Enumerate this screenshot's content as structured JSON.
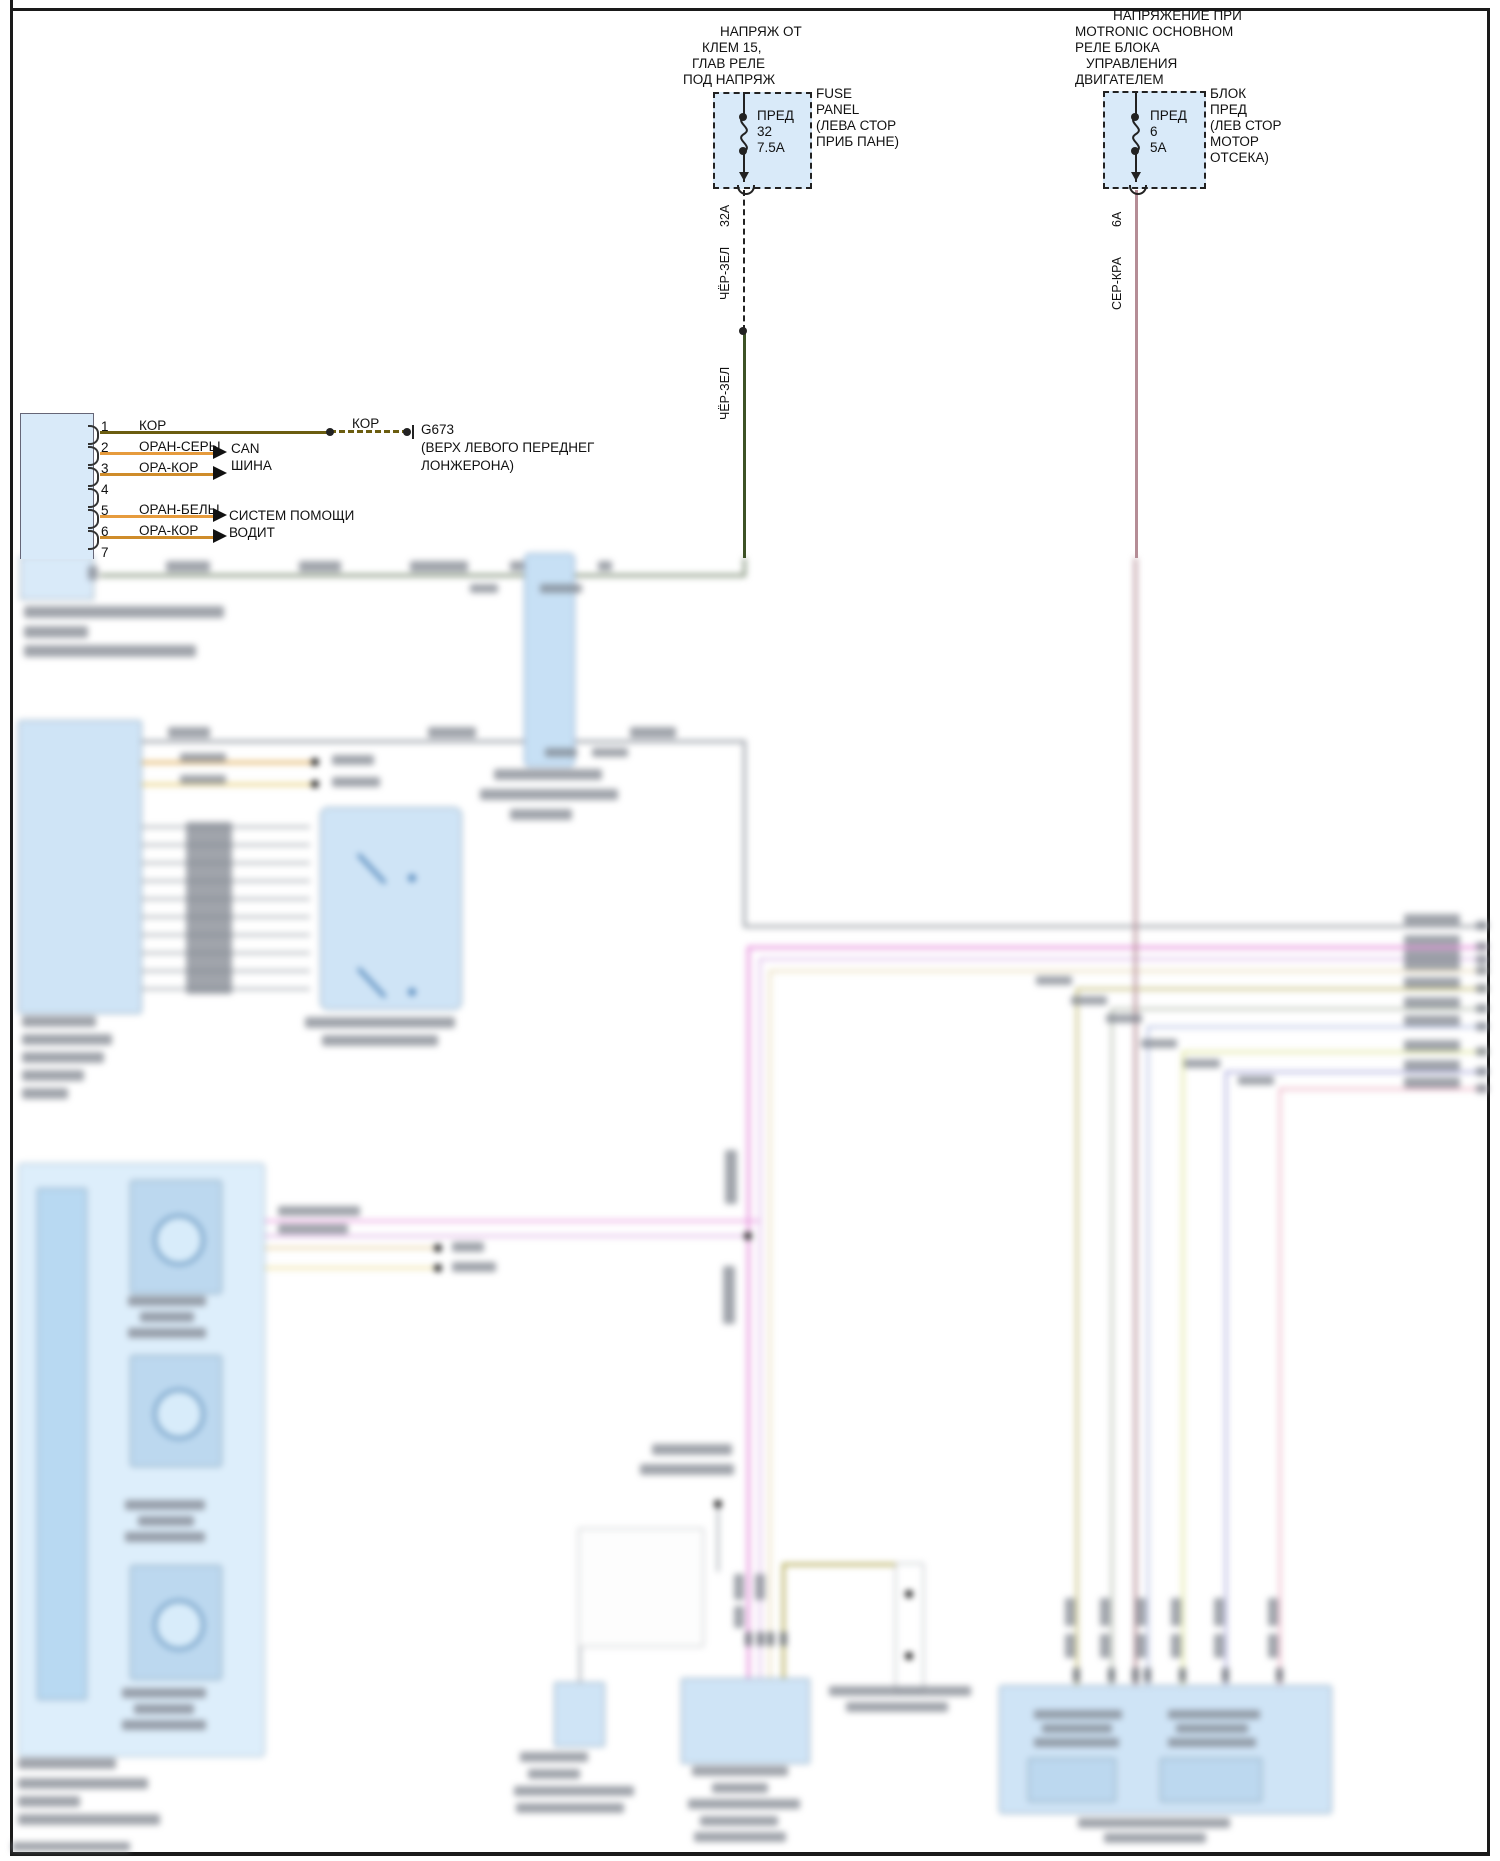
{
  "fuse_left": {
    "title_lines": [
      "НАПРЯЖ ОТ",
      "КЛЕМ 15,",
      "ГЛАВ РЕЛЕ",
      "ПОД НАПРЯЖ"
    ],
    "fuse_label": "ПРЕД",
    "fuse_num": "32",
    "fuse_amp": "7.5А",
    "side_label_lines": [
      "FUSE",
      "PANEL",
      "(ЛЕВА СТОР",
      "ПРИБ ПАНЕ)"
    ],
    "wire_amp": "32А",
    "wire_color_label_upper": "ЧЁР-ЗЕЛ",
    "wire_color_label_lower": "ЧЁР-ЗЕЛ"
  },
  "fuse_right": {
    "title_lines": [
      "НАПРЯЖЕНИЕ ПРИ",
      "MOTRONIC ОСНОВНОМ",
      "РЕЛЕ БЛОКА",
      "УПРАВЛЕНИЯ",
      "ДВИГАТЕЛЕМ"
    ],
    "fuse_label": "ПРЕД",
    "fuse_num": "6",
    "fuse_amp": "5А",
    "side_label_lines": [
      "БЛОК",
      "ПРЕД",
      "(ЛЕВ СТОР",
      "МОТОР",
      "ОТСЕКА)"
    ],
    "wire_amp": "6А",
    "wire_color_label": "СЕР-КРА"
  },
  "connector": {
    "pins": [
      {
        "n": "1",
        "wire": "КОР"
      },
      {
        "n": "2",
        "wire": "ОРАН-СЕРЫ"
      },
      {
        "n": "3",
        "wire": "ОРА-КОР"
      },
      {
        "n": "4",
        "wire": null
      },
      {
        "n": "5",
        "wire": "ОРАН-БЕЛЫ"
      },
      {
        "n": "6",
        "wire": "ОРА-КОР"
      },
      {
        "n": "7",
        "wire": null
      }
    ],
    "can_label_lines": [
      "CAN",
      "ШИНА"
    ],
    "assist_label_lines": [
      "СИСТЕМ ПОМОЩИ",
      "ВОДИТ"
    ],
    "ground": {
      "wire_label": "КОР",
      "id": "G673",
      "desc_lines": [
        "(ВЕРХ ЛЕВОГО ПЕРЕДНЕГ",
        "ЛОНЖЕРОНА)"
      ]
    }
  },
  "colors": {
    "box_fill": "#d9eaf9",
    "blur_box_fill": "#cfe4f6",
    "wire_black_green": "#3d5226",
    "wire_gray_red": "#b58d96",
    "wire_brown": "#6b5d10",
    "wire_orange": "#e69b3d",
    "wire_orange_brown": "#cf8c2a",
    "wire_magenta": "#e690dc",
    "wire_violet": "#d9b0e6",
    "wire_tan": "#e4d4ac",
    "wire_olive": "#b5ad5a",
    "wire_gray_green": "#a9b2a2",
    "wire_lavender": "#aab6de",
    "wire_yellow_green": "#d6de85",
    "wire_blue_violet": "#9b9bd4",
    "wire_pink": "#e8a6bc",
    "wire_gray": "#9aa0a8"
  },
  "sharp_geometry": {
    "hlines": [
      [
        100,
        431,
        230,
        3,
        "#6b5d10"
      ],
      [
        100,
        452,
        113,
        3,
        "#e69b3d"
      ],
      [
        100,
        473,
        113,
        3,
        "#cf8c2a"
      ],
      [
        100,
        515,
        113,
        3,
        "#e69b3d"
      ],
      [
        100,
        536,
        113,
        3,
        "#cf8c2a"
      ]
    ],
    "dash_h": [
      [
        330,
        430,
        78,
        3,
        "#6b5d10"
      ]
    ],
    "vlines": [
      [
        743,
        92,
        27,
        2,
        "#222"
      ],
      [
        743,
        150,
        32,
        2,
        "#222"
      ],
      [
        1135,
        92,
        27,
        2,
        "#222"
      ],
      [
        1135,
        150,
        32,
        2,
        "#222"
      ],
      [
        743,
        331,
        227,
        3,
        "#3d5226"
      ],
      [
        1135,
        190,
        368,
        3,
        "#b58d96"
      ],
      [
        412,
        425,
        14,
        2,
        "#222"
      ]
    ],
    "dash_v": [
      [
        743,
        190,
        141,
        2,
        "#222"
      ]
    ],
    "dots": [
      [
        743,
        117,
        4
      ],
      [
        743,
        151,
        4
      ],
      [
        1135,
        117,
        4
      ],
      [
        1135,
        151,
        4
      ],
      [
        743,
        331,
        4
      ],
      [
        330,
        432,
        4
      ],
      [
        407,
        432,
        4
      ]
    ],
    "arrows_right": [
      [
        213,
        445
      ],
      [
        213,
        466
      ],
      [
        213,
        508
      ],
      [
        213,
        529
      ]
    ],
    "arrows_down": [
      [
        739,
        172
      ],
      [
        1131,
        172
      ]
    ],
    "arcs_u": [
      [
        737,
        185
      ],
      [
        1129,
        185
      ]
    ]
  },
  "blur_geometry": {
    "hlines": [
      [
        100,
        574,
        645,
        3,
        "#7f8f77"
      ],
      [
        140,
        740,
        604,
        3,
        "#9aa0a8"
      ],
      [
        744,
        925,
        744,
        3,
        "#a2a6ac"
      ],
      [
        748,
        946,
        740,
        3,
        "#e690dc"
      ],
      [
        760,
        958,
        728,
        2,
        "#d9b0e6"
      ],
      [
        770,
        970,
        718,
        2,
        "#e4d4ac"
      ],
      [
        1077,
        988,
        411,
        2,
        "#b5ad5a"
      ],
      [
        1112,
        1008,
        376,
        2,
        "#a9b2a2"
      ],
      [
        1148,
        1026,
        340,
        2,
        "#aab6de"
      ],
      [
        1183,
        1051,
        305,
        2,
        "#d6de85"
      ],
      [
        1226,
        1071,
        262,
        2,
        "#9b9bd4"
      ],
      [
        1280,
        1088,
        208,
        2,
        "#e8a6bc"
      ],
      [
        263,
        1220,
        497,
        2,
        "#e690dc"
      ],
      [
        263,
        1235,
        485,
        2,
        "#d9a6e0"
      ],
      [
        263,
        1247,
        175,
        2,
        "#e0c890"
      ],
      [
        263,
        1267,
        175,
        2,
        "#e8d888"
      ],
      [
        140,
        761,
        175,
        3,
        "#e0b060"
      ],
      [
        140,
        783,
        175,
        3,
        "#e8d080"
      ],
      [
        140,
        826,
        170,
        2,
        "#9aa0a8"
      ],
      [
        140,
        844,
        170,
        2,
        "#9aa0a8"
      ],
      [
        140,
        862,
        170,
        2,
        "#9aa0a8"
      ],
      [
        140,
        880,
        170,
        2,
        "#9aa0a8"
      ],
      [
        140,
        898,
        170,
        2,
        "#9aa0a8"
      ],
      [
        140,
        916,
        170,
        2,
        "#9aa0a8"
      ],
      [
        140,
        934,
        170,
        2,
        "#9aa0a8"
      ],
      [
        140,
        952,
        170,
        2,
        "#9aa0a8"
      ],
      [
        140,
        970,
        170,
        2,
        "#9aa0a8"
      ],
      [
        140,
        988,
        170,
        2,
        "#9aa0a8"
      ],
      [
        783,
        1563,
        130,
        3,
        "#b5ad5a"
      ]
    ],
    "vlines": [
      [
        743,
        558,
        19,
        3,
        "#7f8f77"
      ],
      [
        743,
        740,
        187,
        3,
        "#9aa0a8"
      ],
      [
        1134,
        558,
        1127,
        3,
        "#b58d96"
      ],
      [
        747,
        946,
        732,
        3,
        "#e690dc"
      ],
      [
        759,
        958,
        720,
        2,
        "#d9b0e6"
      ],
      [
        769,
        970,
        708,
        2,
        "#e4d4ac"
      ],
      [
        1076,
        988,
        697,
        2,
        "#b5ad5a"
      ],
      [
        1111,
        1008,
        677,
        2,
        "#a9b2a2"
      ],
      [
        1147,
        1026,
        659,
        2,
        "#aab6de"
      ],
      [
        1182,
        1051,
        634,
        2,
        "#d6de85"
      ],
      [
        1225,
        1071,
        614,
        2,
        "#9b9bd4"
      ],
      [
        1279,
        1088,
        597,
        2,
        "#e8a6bc"
      ],
      [
        782,
        1563,
        115,
        3,
        "#b5ad5a"
      ],
      [
        909,
        1563,
        31,
        3,
        "#b5ad5a"
      ],
      [
        909,
        1654,
        28,
        3,
        "#b5ad5a"
      ],
      [
        579,
        1645,
        37,
        2,
        "#9aa0a8"
      ],
      [
        717,
        1508,
        64,
        2,
        "#9aa0a8"
      ]
    ],
    "boxes": [
      [
        20,
        556,
        72,
        42,
        "#d9eaf9",
        "#8a9aa8",
        0
      ],
      [
        524,
        553,
        49,
        212,
        "#c7e0f5",
        "#7d9cc0",
        6
      ],
      [
        18,
        720,
        122,
        292,
        "#cfe4f6",
        "#8099b0",
        3
      ],
      [
        320,
        807,
        140,
        201,
        "#cfe4f6",
        "#8099b0",
        8
      ],
      [
        18,
        1163,
        245,
        592,
        "#ddeefb",
        "#9ab0c4",
        4
      ],
      [
        37,
        1188,
        48,
        510,
        "#b8d9f2",
        "#8099b0",
        2
      ],
      [
        130,
        1180,
        90,
        112,
        "#bcd8ef",
        "#7f98ac",
        3
      ],
      [
        130,
        1355,
        90,
        110,
        "#bcd8ef",
        "#7f98ac",
        3
      ],
      [
        130,
        1565,
        90,
        113,
        "#bcd8ef",
        "#7f98ac",
        3
      ],
      [
        578,
        1528,
        124,
        117,
        "#fdfdfd",
        "#b0b4b8",
        2
      ],
      [
        554,
        1682,
        49,
        63,
        "#cfe4f6",
        "#8099b0",
        2
      ],
      [
        681,
        1678,
        127,
        84,
        "#cfe4f6",
        "#8099b0",
        2
      ],
      [
        895,
        1563,
        27,
        127,
        "#ffffff",
        "#9aa0a8",
        2
      ],
      [
        999,
        1685,
        331,
        127,
        "#cfe4f6",
        "#8099b0",
        3
      ],
      [
        1028,
        1758,
        86,
        42,
        "#bcd8ef",
        "#7f98ac",
        2
      ],
      [
        1160,
        1758,
        100,
        42,
        "#bcd8ef",
        "#7f98ac",
        2
      ]
    ],
    "circles": [
      [
        175,
        1236,
        22
      ],
      [
        175,
        1410,
        22
      ],
      [
        175,
        1621,
        22
      ]
    ],
    "switches": [
      [
        358,
        852,
        40,
        47
      ],
      [
        358,
        966,
        40,
        47
      ]
    ],
    "blue_dots": [
      [
        412,
        878,
        4
      ],
      [
        412,
        992,
        4
      ]
    ],
    "dots": [
      [
        748,
        1236,
        4
      ],
      [
        438,
        1248,
        4
      ],
      [
        438,
        1268,
        4
      ],
      [
        315,
        762,
        4
      ],
      [
        315,
        784,
        4
      ],
      [
        909,
        1594,
        4
      ],
      [
        909,
        1656,
        4
      ],
      [
        718,
        1504,
        4
      ]
    ],
    "smudges": [
      [
        166,
        561,
        44,
        11
      ],
      [
        299,
        561,
        42,
        11
      ],
      [
        410,
        561,
        58,
        11
      ],
      [
        470,
        584,
        28,
        9
      ],
      [
        540,
        584,
        42,
        9
      ],
      [
        510,
        561,
        14,
        10
      ],
      [
        598,
        561,
        14,
        10
      ],
      [
        24,
        606,
        200,
        12
      ],
      [
        24,
        626,
        64,
        12
      ],
      [
        24,
        645,
        172,
        12
      ],
      [
        168,
        727,
        42,
        11
      ],
      [
        428,
        727,
        48,
        11
      ],
      [
        630,
        727,
        46,
        11
      ],
      [
        545,
        748,
        32,
        9
      ],
      [
        592,
        748,
        36,
        9
      ],
      [
        494,
        769,
        108,
        11
      ],
      [
        480,
        789,
        138,
        11
      ],
      [
        510,
        809,
        62,
        11
      ],
      [
        22,
        1016,
        74,
        11
      ],
      [
        22,
        1034,
        90,
        11
      ],
      [
        22,
        1052,
        82,
        11
      ],
      [
        22,
        1070,
        62,
        11
      ],
      [
        22,
        1088,
        46,
        11
      ],
      [
        305,
        1017,
        150,
        11
      ],
      [
        322,
        1035,
        116,
        11
      ],
      [
        332,
        755,
        42,
        10
      ],
      [
        332,
        777,
        48,
        10
      ],
      [
        180,
        753,
        46,
        9
      ],
      [
        180,
        775,
        46,
        9
      ],
      [
        186,
        822,
        46,
        172
      ],
      [
        1404,
        914,
        56,
        11
      ],
      [
        1476,
        921,
        12,
        9
      ],
      [
        1404,
        935,
        56,
        11
      ],
      [
        1476,
        942,
        12,
        9
      ],
      [
        1404,
        949,
        56,
        11
      ],
      [
        1476,
        955,
        12,
        9
      ],
      [
        1404,
        959,
        56,
        11
      ],
      [
        1476,
        966,
        12,
        9
      ],
      [
        1404,
        977,
        56,
        11
      ],
      [
        1476,
        984,
        12,
        9
      ],
      [
        1404,
        997,
        56,
        11
      ],
      [
        1476,
        1004,
        12,
        9
      ],
      [
        1404,
        1015,
        56,
        11
      ],
      [
        1476,
        1022,
        12,
        9
      ],
      [
        1404,
        1040,
        56,
        11
      ],
      [
        1476,
        1047,
        12,
        9
      ],
      [
        1404,
        1060,
        56,
        11
      ],
      [
        1476,
        1067,
        12,
        9
      ],
      [
        1404,
        1077,
        56,
        11
      ],
      [
        1476,
        1084,
        12,
        9
      ],
      [
        1036,
        976,
        36,
        9
      ],
      [
        1071,
        996,
        36,
        9
      ],
      [
        1106,
        1014,
        36,
        9
      ],
      [
        1141,
        1039,
        36,
        9
      ],
      [
        1184,
        1059,
        36,
        9
      ],
      [
        1238,
        1076,
        36,
        9
      ],
      [
        652,
        1444,
        80,
        11
      ],
      [
        640,
        1464,
        94,
        11
      ],
      [
        278,
        1206,
        82,
        10
      ],
      [
        278,
        1224,
        70,
        10
      ],
      [
        452,
        1242,
        32,
        10
      ],
      [
        452,
        1262,
        44,
        10
      ],
      [
        128,
        1296,
        78,
        10
      ],
      [
        140,
        1312,
        54,
        10
      ],
      [
        128,
        1328,
        78,
        10
      ],
      [
        125,
        1500,
        80,
        10
      ],
      [
        138,
        1516,
        56,
        10
      ],
      [
        125,
        1532,
        80,
        10
      ],
      [
        122,
        1688,
        84,
        10
      ],
      [
        134,
        1704,
        60,
        10
      ],
      [
        122,
        1720,
        84,
        10
      ],
      [
        18,
        1758,
        98,
        11
      ],
      [
        18,
        1778,
        130,
        11
      ],
      [
        18,
        1796,
        62,
        11
      ],
      [
        18,
        1814,
        142,
        11
      ],
      [
        520,
        1752,
        68,
        10
      ],
      [
        528,
        1769,
        52,
        10
      ],
      [
        514,
        1786,
        120,
        10
      ],
      [
        516,
        1803,
        108,
        10
      ],
      [
        692,
        1766,
        96,
        10
      ],
      [
        712,
        1783,
        56,
        10
      ],
      [
        688,
        1799,
        112,
        10
      ],
      [
        700,
        1816,
        78,
        10
      ],
      [
        694,
        1832,
        92,
        10
      ],
      [
        829,
        1686,
        142,
        10
      ],
      [
        846,
        1702,
        102,
        10
      ],
      [
        1034,
        1710,
        88,
        9
      ],
      [
        1042,
        1724,
        70,
        9
      ],
      [
        1034,
        1738,
        85,
        9
      ],
      [
        1168,
        1710,
        92,
        9
      ],
      [
        1176,
        1724,
        72,
        9
      ],
      [
        1168,
        1738,
        88,
        9
      ],
      [
        1078,
        1818,
        152,
        10
      ],
      [
        1104,
        1833,
        102,
        10
      ],
      [
        12,
        1842,
        118,
        9
      ],
      [
        88,
        566,
        10,
        14
      ]
    ],
    "vsmudges": [
      [
        725,
        1150,
        12,
        54
      ],
      [
        723,
        1266,
        12,
        58
      ],
      [
        1065,
        1598,
        10,
        28
      ],
      [
        1065,
        1634,
        10,
        24
      ],
      [
        1100,
        1598,
        10,
        28
      ],
      [
        1100,
        1634,
        10,
        24
      ],
      [
        1136,
        1598,
        10,
        28
      ],
      [
        1136,
        1634,
        10,
        24
      ],
      [
        1171,
        1598,
        10,
        28
      ],
      [
        1171,
        1634,
        10,
        24
      ],
      [
        1214,
        1598,
        10,
        28
      ],
      [
        1214,
        1634,
        10,
        24
      ],
      [
        1268,
        1598,
        10,
        28
      ],
      [
        1268,
        1634,
        10,
        24
      ],
      [
        734,
        1574,
        10,
        26
      ],
      [
        734,
        1606,
        10,
        22
      ],
      [
        755,
        1574,
        10,
        26
      ]
    ],
    "pinrects": [
      [
        745,
        1632
      ],
      [
        757,
        1632
      ],
      [
        767,
        1632
      ],
      [
        780,
        1632
      ],
      [
        1073,
        1668
      ],
      [
        1108,
        1668
      ],
      [
        1132,
        1668
      ],
      [
        1144,
        1668
      ],
      [
        1179,
        1668
      ],
      [
        1222,
        1668
      ],
      [
        1276,
        1668
      ]
    ]
  }
}
